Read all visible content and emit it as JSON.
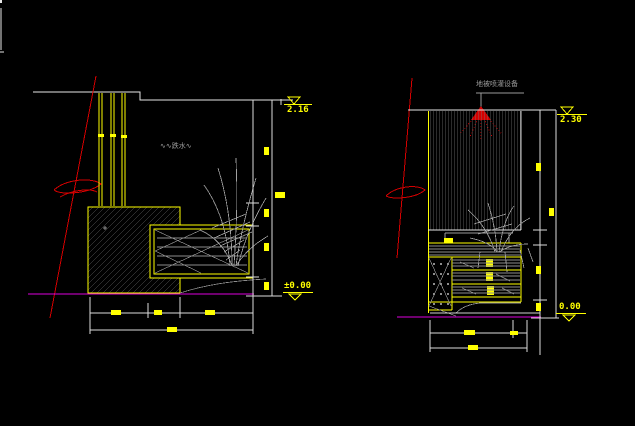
{
  "drawing": {
    "type": "cad-landscape-water-feature-elevations",
    "background": "#000000",
    "colors": {
      "outline_white": "#e6e6e6",
      "detail_yellow": "#ffff00",
      "section_red": "#d40000",
      "ground_magenta": "#dd00dd",
      "hatch_gray": "#7d7d7d",
      "plant_gray": "#a0a0a0"
    }
  },
  "left_drawing": {
    "name": "water wall front elevation",
    "water_label": "∿∿跌水∿",
    "elevation_top": "2.16",
    "elevation_bottom": "±0.00"
  },
  "right_drawing": {
    "name": "water wall side section",
    "sprinkler_label": "地被喷灌设备",
    "elevation_top": "2.30",
    "elevation_bottom": "0.00"
  }
}
